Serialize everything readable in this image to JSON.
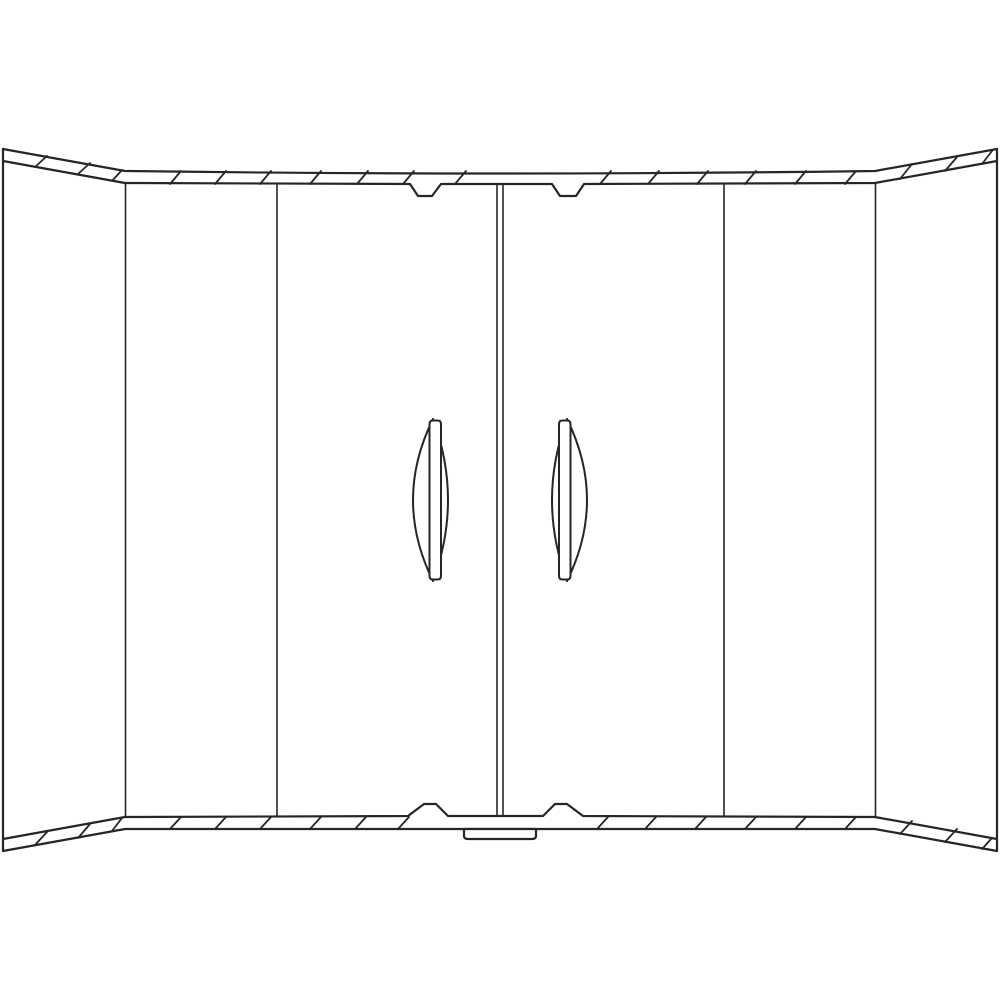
{
  "meta": {
    "description": "Black-and-white technical line drawing of a double-door wardrobe cabinet front, viewed straight on, with curved segmented top and bottom rails, angled side panels, a central door gap, two vertical lens-shaped door handles and a small latch plate at the bottom center.",
    "image_width": 1000,
    "image_height": 1000
  },
  "colors": {
    "background": "#ffffff",
    "stroke": "#262626",
    "handle_fill": "#ffffff",
    "latch_fill": "#ffffff"
  },
  "drawing": {
    "viewbox": "0 0 1000 1000",
    "paths": {
      "left_edge": "M3,149 L3,850",
      "right_edge": "M997,149 L997,850",
      "top_rail_upper": "M3,149 L125,171 Q500,176 875,171 L997,149",
      "top_rail_lower": "M3,161 L125,183 L410,184 L418,196 L432,196 L441,184 L552,184 L560,196 L576,196 L584,184 L875,183 L997,161",
      "top_rail_hatches": "M35,167 L47,156 M78,174 L90,163 M112,181 L122,170 M170,184 L181,171 M215,184 L226,171 M260,184 L271,171 M310,184 L321,171 M357,184 L368,171 M403,184 L414,171 M455,184 L466,171 M600,184 L611,171 M648,184 L659,171 M697,184 L708,171 M745,184 L756,171 M795,184 L806,171 M845,184 L856,171 M900,179 L912,164 M945,171 L957,157 M982,164 L992,151",
      "bottom_rail_upper": "M3,839 L125,817 L408,816 L424,804 L436,804 L448,816 L543,816 L555,804 L567,804 L583,816 L875,817 L997,839",
      "bottom_rail_lower": "M3,851 L125,829 L875,829 L997,851",
      "bottom_rail_hatches": "M35,845 L47,832 M78,838 L90,824 M112,831 L122,818 M170,829 L181,817 M215,829 L226,817 M260,829 L271,817 M310,829 L321,817 M355,829 L366,817 M398,829 L409,817 M597,829 L608,817 M645,829 L656,817 M695,829 L706,817 M745,829 L756,817 M795,829 L806,817 M845,829 L856,817 M900,834 L912,821 M945,842 L957,829 M982,849 L992,838",
      "panel_dividers": "M125.5,184 L125.5,816 M277,185 L277,816 M724,185 L724,816 M875.5,184 L875.5,816",
      "center_gap": "M497,184 L497,816 M503,184 L503,816",
      "left_handle_lens": "M433,419 Q393,500 433,581 Q463,500 433,419 Z",
      "left_handle_bar": "M429.5,424 Q429.5,420.5 433,420.5 L437.5,420.5 Q441,420.5 441,424 L441,576 Q441,579.5 437.5,579.5 L433,579.5 Q429.5,579.5 429.5,576 Z",
      "right_handle_lens": "M567,419 Q607,500 567,581 Q537,500 567,419 Z",
      "right_handle_bar": "M559,424 Q559,420.5 562.5,420.5 L567,420.5 Q570.5,420.5 570.5,424 L570.5,576 Q570.5,579.5 567,579.5 L562.5,579.5 Q559,579.5 559,576 Z",
      "latch_plate": "M464,829 L464,836 Q464,839 468,839 L532,839 Q536,839 536,836 L536,829 Z"
    }
  }
}
